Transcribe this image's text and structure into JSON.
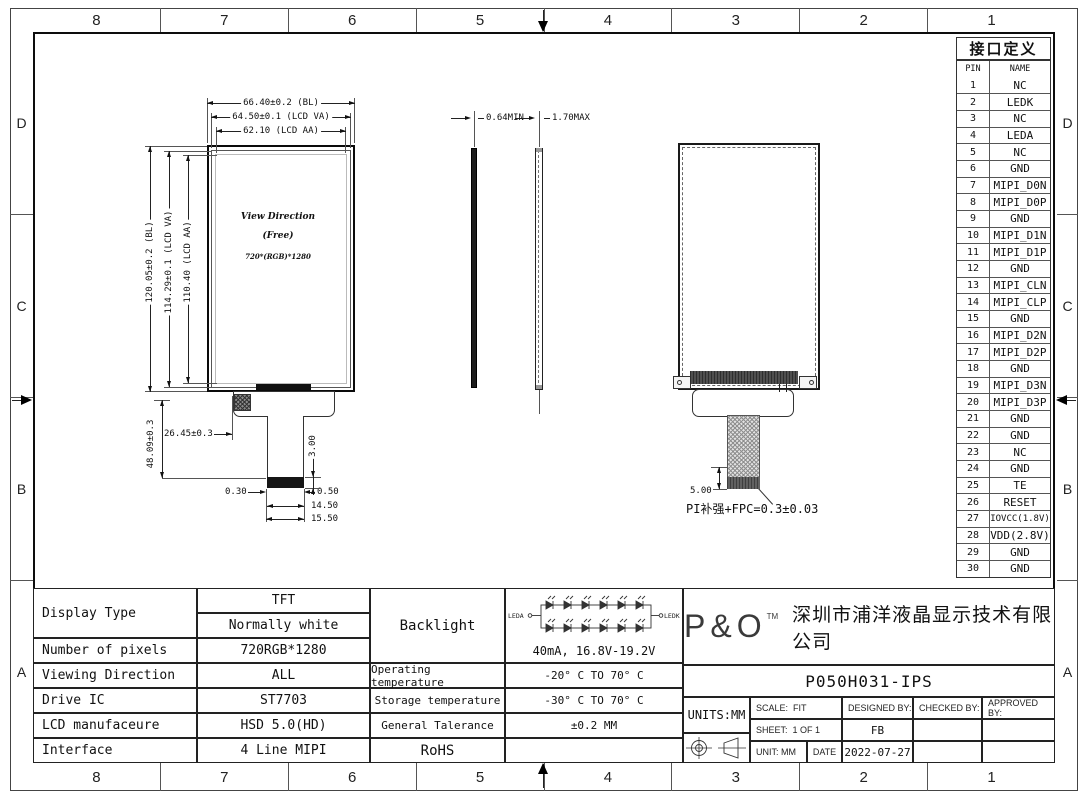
{
  "frame": {
    "zone_cols_top": [
      "8",
      "7",
      "6",
      "5",
      "4",
      "3",
      "2",
      "1"
    ],
    "zone_cols_bottom": [
      "8",
      "7",
      "6",
      "5",
      "4",
      "3",
      "2",
      "1"
    ],
    "zone_rows_left": [
      "D",
      "C",
      "B",
      "A"
    ],
    "zone_rows_right": [
      "D",
      "C",
      "B",
      "A"
    ]
  },
  "pin_table": {
    "title": "接口定义",
    "headers": {
      "pin": "PIN",
      "name": "NAME"
    },
    "rows": [
      {
        "pin": "1",
        "name": "NC"
      },
      {
        "pin": "2",
        "name": "LEDK"
      },
      {
        "pin": "3",
        "name": "NC"
      },
      {
        "pin": "4",
        "name": "LEDA"
      },
      {
        "pin": "5",
        "name": "NC"
      },
      {
        "pin": "6",
        "name": "GND"
      },
      {
        "pin": "7",
        "name": "MIPI_D0N"
      },
      {
        "pin": "8",
        "name": "MIPI_D0P"
      },
      {
        "pin": "9",
        "name": "GND"
      },
      {
        "pin": "10",
        "name": "MIPI_D1N"
      },
      {
        "pin": "11",
        "name": "MIPI_D1P"
      },
      {
        "pin": "12",
        "name": "GND"
      },
      {
        "pin": "13",
        "name": "MIPI_CLN"
      },
      {
        "pin": "14",
        "name": "MIPI_CLP"
      },
      {
        "pin": "15",
        "name": "GND"
      },
      {
        "pin": "16",
        "name": "MIPI_D2N"
      },
      {
        "pin": "17",
        "name": "MIPI_D2P"
      },
      {
        "pin": "18",
        "name": "GND"
      },
      {
        "pin": "19",
        "name": "MIPI_D3N"
      },
      {
        "pin": "20",
        "name": "MIPI_D3P"
      },
      {
        "pin": "21",
        "name": "GND"
      },
      {
        "pin": "22",
        "name": "GND"
      },
      {
        "pin": "23",
        "name": "NC"
      },
      {
        "pin": "24",
        "name": "GND"
      },
      {
        "pin": "25",
        "name": "TE"
      },
      {
        "pin": "26",
        "name": "RESET"
      },
      {
        "pin": "27",
        "name": "IOVCC(1.8V)"
      },
      {
        "pin": "28",
        "name": "VDD(2.8V)"
      },
      {
        "pin": "29",
        "name": "GND"
      },
      {
        "pin": "30",
        "name": "GND"
      }
    ]
  },
  "front_view": {
    "dim_top_bl": "66.40±0.2 (BL)",
    "dim_top_va": "64.50±0.1 (LCD VA)",
    "dim_top_aa": "62.10 (LCD AA)",
    "dim_left_bl": "120.05±0.2 (BL)",
    "dim_left_va": "114.29±0.1 (LCD VA)",
    "dim_left_aa": "110.40 (LCD AA)",
    "dim_fpc_height": "48.09±0.3",
    "dim_fpc_offset": "26.45±0.3",
    "view_direction": "View Direction",
    "view_free": "(Free)",
    "resolution": "720*(RGB)*1280",
    "dim_connector_h": "3.00",
    "dim_gap_left": "0.30",
    "dim_gap_right": "0.50",
    "dim_connector_w": "14.50",
    "dim_tail_w": "15.50"
  },
  "side_view": {
    "dim_thickness_min": "0.64MIN",
    "dim_thickness_max": "1.70MAX"
  },
  "back_view": {
    "dim_stiffener": "5.00",
    "fpc_note": "PI补强+FPC=0.3±0.03"
  },
  "spec": {
    "display_type_label": "Display Type",
    "display_type_value1": "TFT",
    "display_type_value2": "Normally white",
    "pixels_label": "Number of pixels",
    "pixels_value": "720RGB*1280",
    "viewing_label": "Viewing Direction",
    "viewing_value": "ALL",
    "drive_label": "Drive IC",
    "drive_value": "ST7703",
    "manufacture_label": "LCD manufaceure",
    "manufacture_value": "HSD 5.0(HD)",
    "interface_label": "Interface",
    "interface_value": "4 Line MIPI",
    "backlight_label": "Backlight",
    "backlight_leda": "LEDA",
    "backlight_ledk": "LEDK",
    "backlight_value": "40mA, 16.8V-19.2V",
    "op_temp_label": "Operating temperature",
    "op_temp_value": "-20° C TO 70° C",
    "st_temp_label": "Storage temperature",
    "st_temp_value": "-30° C TO 70° C",
    "tolerance_label": "General Talerance",
    "tolerance_value": "±0.2 MM",
    "rohs_label": "RoHS"
  },
  "title_block": {
    "logo": "P&O",
    "logo_tm": "TM",
    "company": "深圳市浦洋液晶显示技术有限公司",
    "part_number": "P050H031-IPS",
    "units": "UNITS:MM",
    "scale_label": "SCALE:",
    "scale_value": "FIT",
    "sheet_label": "SHEET:",
    "sheet_value": "1 OF 1",
    "unit_label": "UNIT:",
    "unit_value": "MM",
    "date_label": "DATE",
    "designed_label": "DESIGNED BY:",
    "designed_value": "FB",
    "checked_label": "CHECKED BY:",
    "approved_label": "APPROVED BY:",
    "date_value": "2022-07-27"
  }
}
